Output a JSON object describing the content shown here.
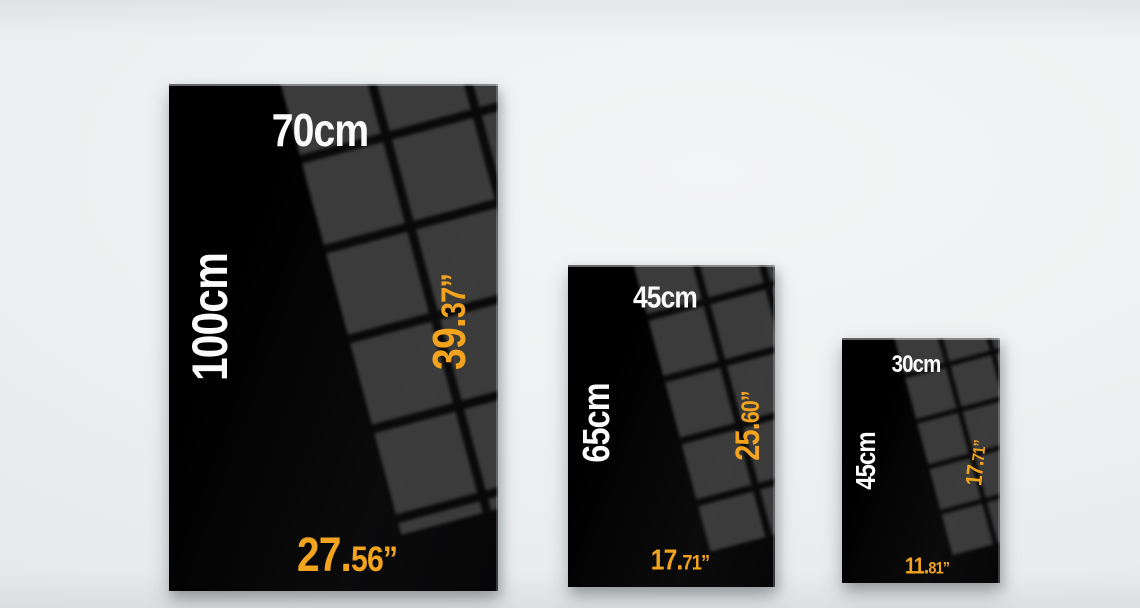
{
  "colors": {
    "accent_orange": "#F2A41E",
    "poster_black": "#0A0A0B",
    "reflection_gray": "#3E3E3E",
    "label_white": "#FBFBFB",
    "wall_light_gray": "#EEF0F1"
  },
  "posters": [
    {
      "name": "poster-100x70",
      "cm_width": "70cm",
      "cm_height": "100cm",
      "in_height_main": "39.",
      "in_height_sub": "37”",
      "in_width_main": "27.",
      "in_width_sub": "56”"
    },
    {
      "name": "poster-65x45",
      "cm_width": "45cm",
      "cm_height": "65cm",
      "in_height_main": "25.",
      "in_height_sub": "60”",
      "in_width_main": "17.",
      "in_width_sub": "71”"
    },
    {
      "name": "poster-45x30",
      "cm_width": "30cm",
      "cm_height": "45cm",
      "in_height_main": "17.",
      "in_height_sub": "71”",
      "in_width_main": "11.",
      "in_width_sub": "81”"
    }
  ]
}
